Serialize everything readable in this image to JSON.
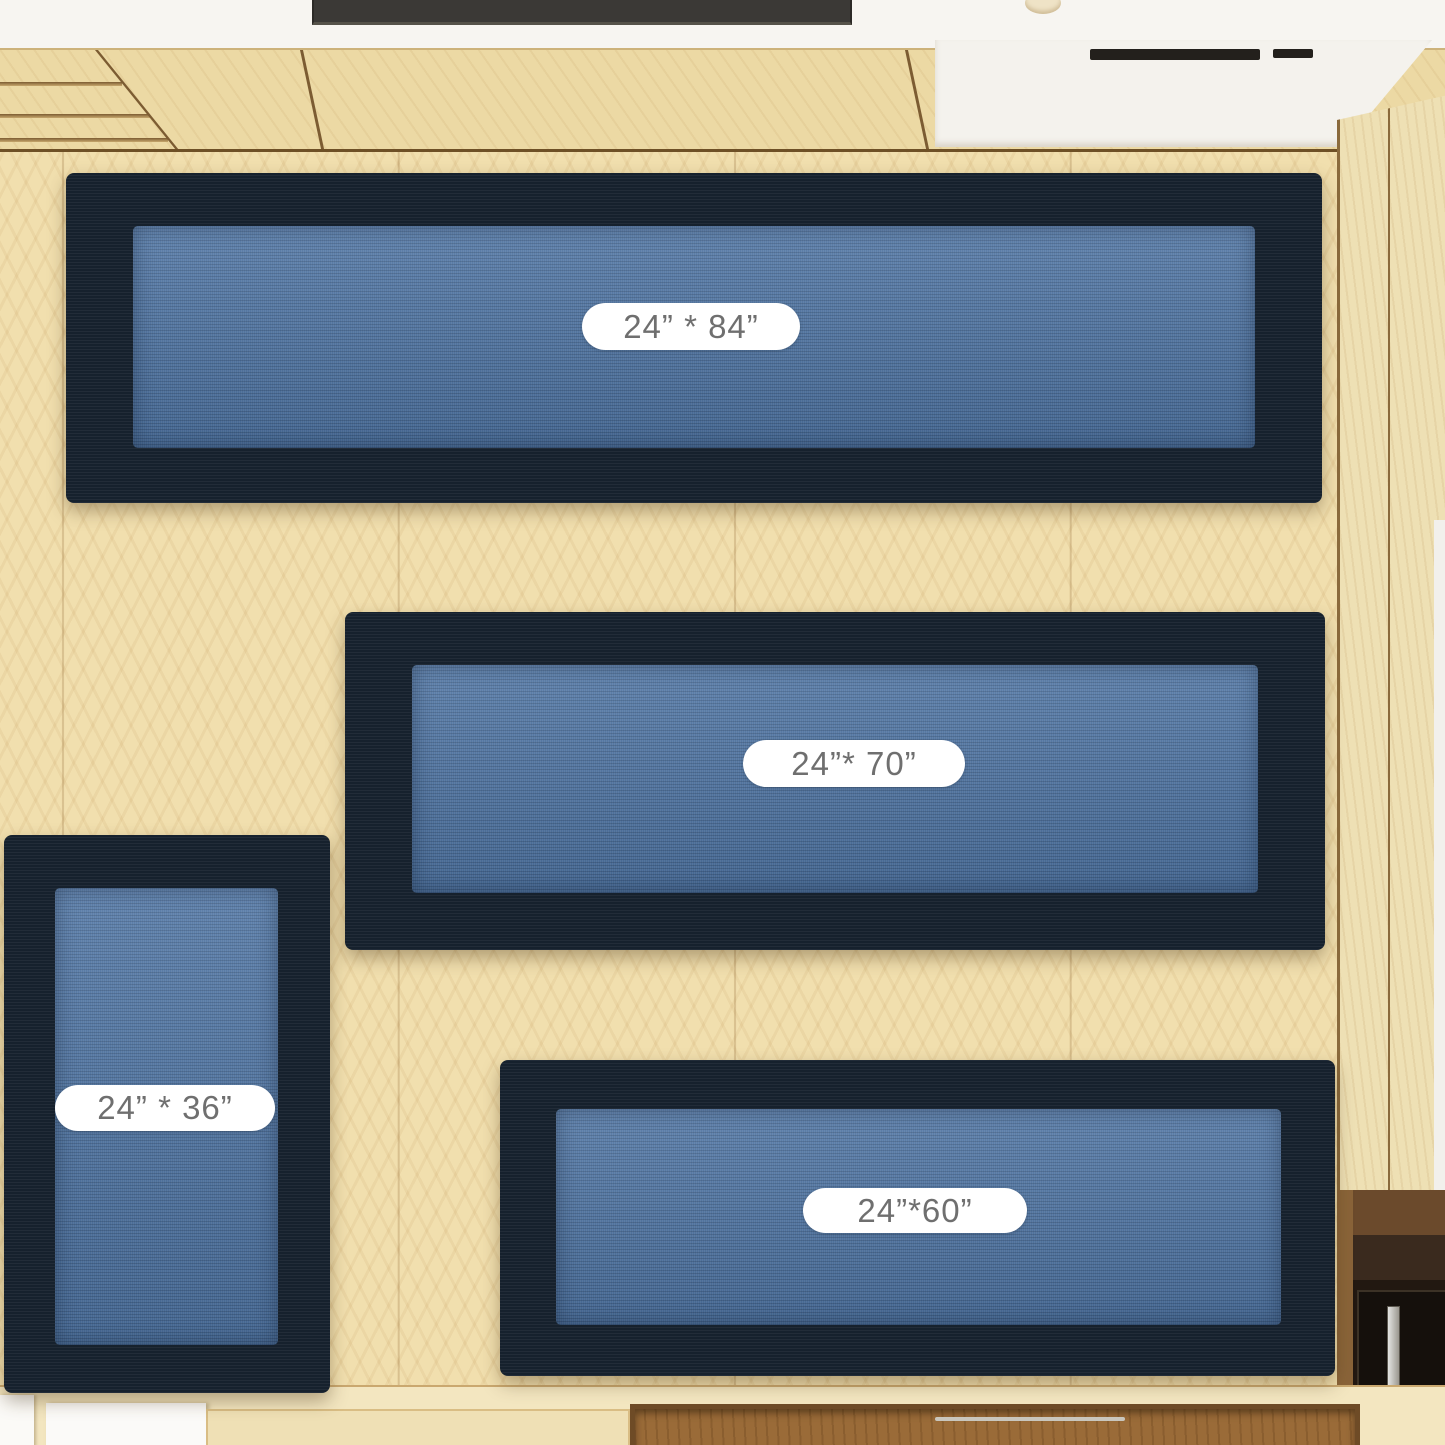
{
  "scene": {
    "rugs": [
      {
        "name": "runner-24x84",
        "size_label": "24” * 84”"
      },
      {
        "name": "runner-24x70",
        "size_label": "24”* 70”"
      },
      {
        "name": "mat-24x36",
        "size_label": "24” * 36”"
      },
      {
        "name": "runner-24x60",
        "size_label": "24”*60”"
      }
    ],
    "colors": {
      "rug_border": "#16212d",
      "rug_field": "#4d73a2",
      "floor_wood": "#f1dfae",
      "cabinet_wood": "#ecd9a4",
      "wall_white": "#f7f5f1",
      "label_text": "#6f6f6f",
      "label_background": "#ffffff"
    }
  }
}
